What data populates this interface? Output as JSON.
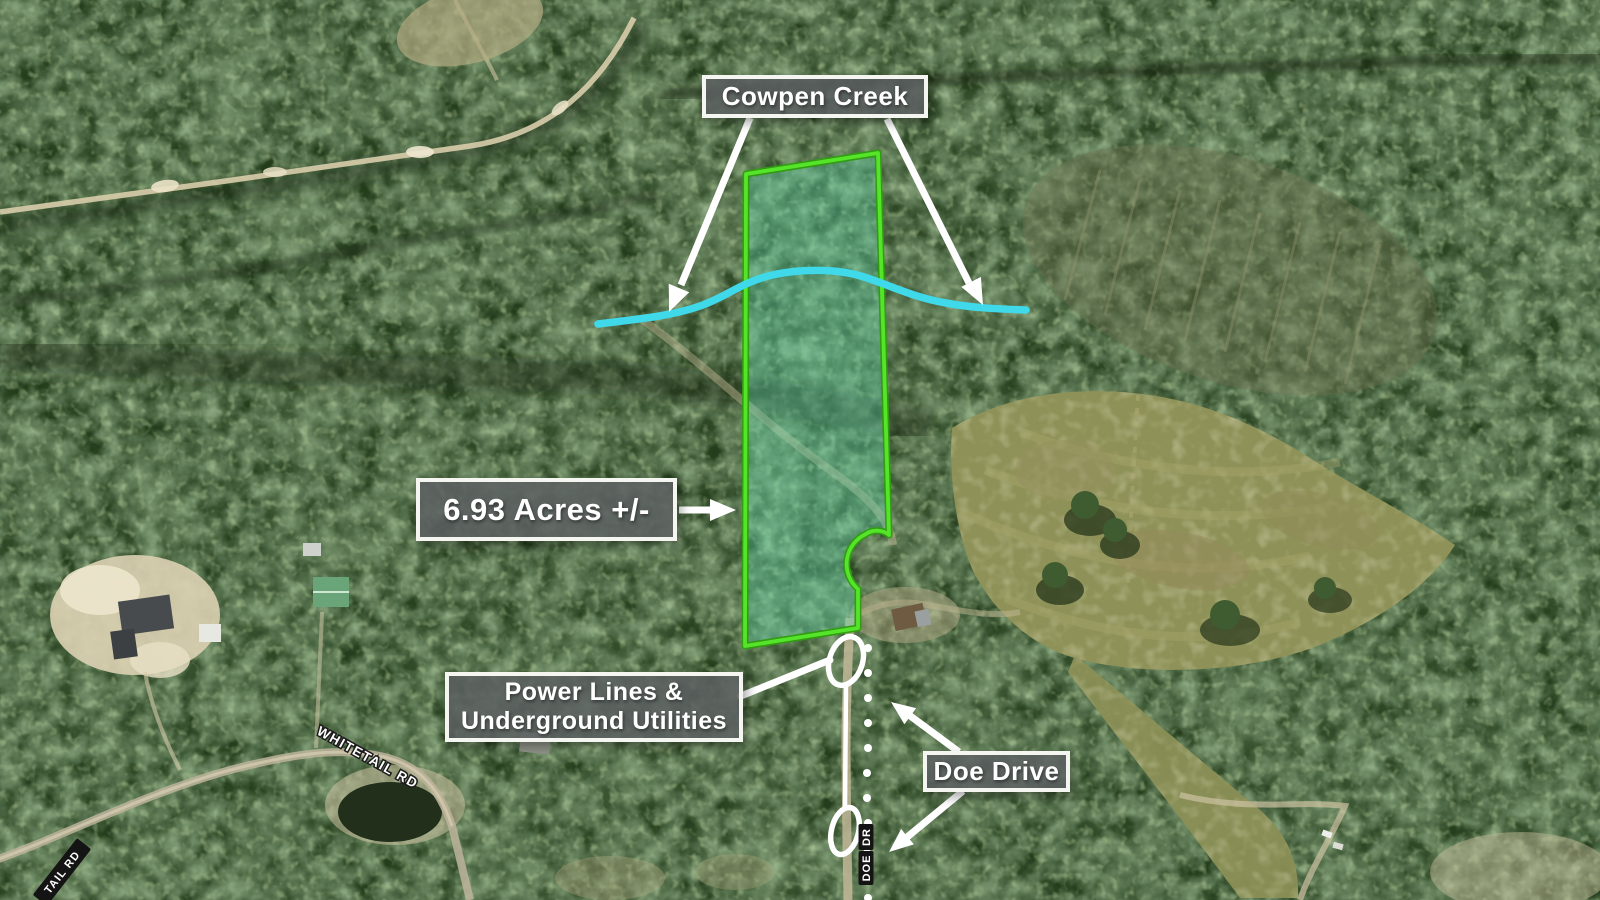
{
  "map": {
    "type": "annotated-aerial-property-map",
    "labels": {
      "creek": "Cowpen Creek",
      "acreage": "6.93 Acres +/-",
      "utilities": {
        "line1": "Power Lines &",
        "line2": "Underground Utilities"
      },
      "road": "Doe Drive"
    },
    "road_names": {
      "whitetail": "WHITETAIL RD",
      "whitetail_partial": "TAIL RD",
      "doe_chip_1": "DR",
      "doe_chip_2": "DOE"
    },
    "colors": {
      "parcel_stroke": "#55e42a",
      "parcel_stroke_dark": "#2f9e10",
      "parcel_fill": "rgba(97,218,177,0.38)",
      "creek": "#3fd9e9",
      "annotation": "#ffffff",
      "label_bg": "rgba(92,95,97,0.85)",
      "label_border": "#f5f5f2",
      "label_text": "#ffffff",
      "road_chip_bg": "#141414"
    }
  }
}
